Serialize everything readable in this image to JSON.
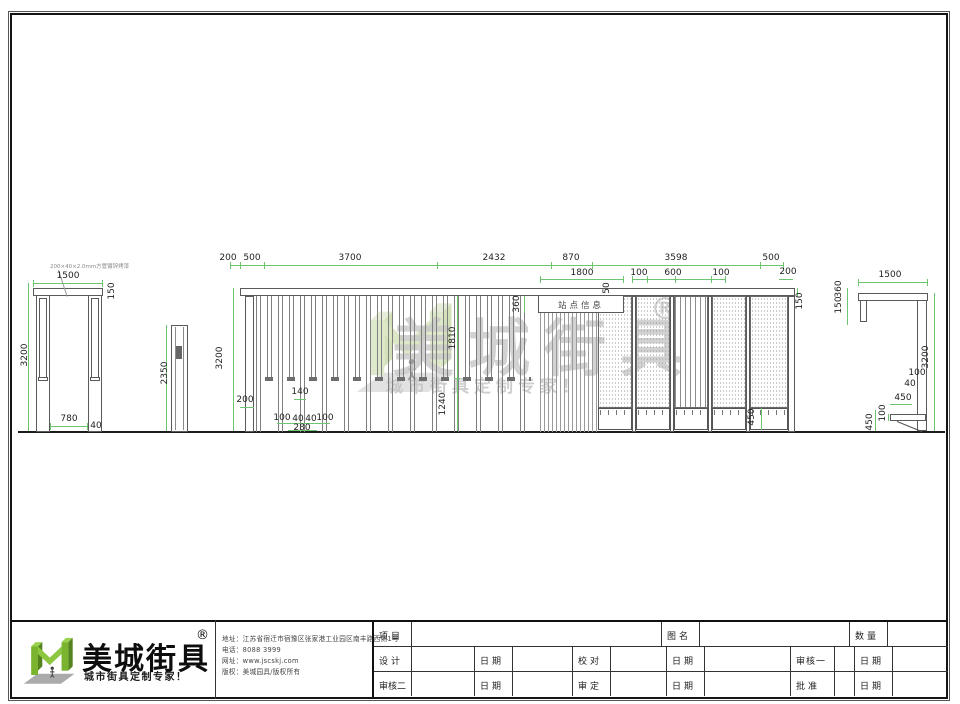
{
  "watermark": {
    "brand": "美城街具",
    "reg": "®",
    "tagline": "城市街具定制专家！"
  },
  "drawing": {
    "left_view": {
      "note": "200×40×2.0mm方管镀锌烤漆",
      "d1500": "1500",
      "d150": "150",
      "d3200": "3200",
      "d780": "780",
      "d40": "40"
    },
    "post_view": {
      "d2350": "2350"
    },
    "center_view": {
      "sign_text": "站点信息",
      "top_dims": [
        "200",
        "500",
        "3700",
        "2432",
        "870",
        "3598",
        "500"
      ],
      "d1800": "1800",
      "d50": "50",
      "d100a": "100",
      "d600": "600",
      "d100b": "100",
      "d200r": "200",
      "d150r": "150",
      "d360": "360",
      "d3200": "3200",
      "d200": "200",
      "d140": "140",
      "d100c": "100",
      "d40a": "40",
      "d40b": "40",
      "d100d": "100",
      "d280": "280",
      "d1810": "1810",
      "d1240": "1240",
      "d450": "450"
    },
    "right_view": {
      "d1500": "1500",
      "d360": "360",
      "d150": "150",
      "d3200": "3200",
      "d100a": "100",
      "d40": "40",
      "d450a": "450",
      "d100b": "100",
      "d450b": "450"
    }
  },
  "titleblock": {
    "brand": "美城街具",
    "reg": "®",
    "tagline": "城市街具定制专家！",
    "contact": {
      "address": "地址：江苏省宿迁市宿豫区张家港工业园区南丰路西侧1号",
      "phone": "电话：8088 3999",
      "website": "网址：www.jscskj.com",
      "copyright": "版权：美城园具/版权所有"
    },
    "table": {
      "row1": [
        "项目",
        "",
        "图名",
        "",
        "数量",
        ""
      ],
      "row2": [
        "设计",
        "",
        "日期",
        "",
        "校对",
        "",
        "日期",
        "",
        "审核一",
        "",
        "日期",
        ""
      ],
      "row3": [
        "审核二",
        "",
        "日期",
        "",
        "审定",
        "",
        "日期",
        "",
        "批准",
        "",
        "日期",
        ""
      ]
    }
  },
  "colors": {
    "dim_green": "#6fc46f",
    "logo_green": "#8dc63f",
    "line_dark": "#5a5a5a"
  }
}
